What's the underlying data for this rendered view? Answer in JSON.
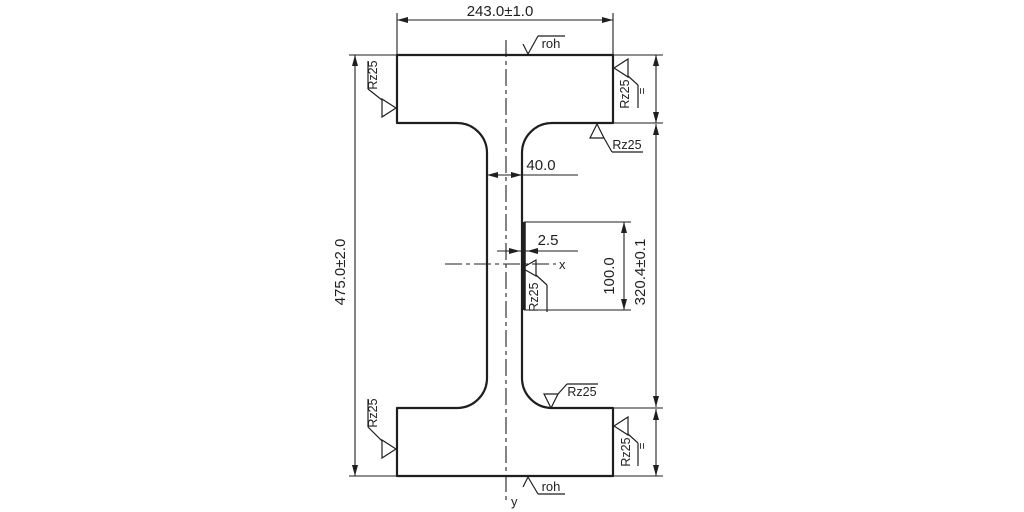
{
  "labels": {
    "flange_width": "243.0±1.0",
    "overall_height": "475.0±2.0",
    "web_width": "40.0",
    "seam_thickness": "2.5",
    "seam_length": "100.0",
    "inner_height": "320.4±0.1",
    "roughness": "Rz25",
    "raw_surface": "roh",
    "lay_parallel": "=",
    "axis_x": "x",
    "axis_y": "y"
  },
  "colors": {
    "line": "#1f1f1f",
    "background": "#ffffff"
  }
}
